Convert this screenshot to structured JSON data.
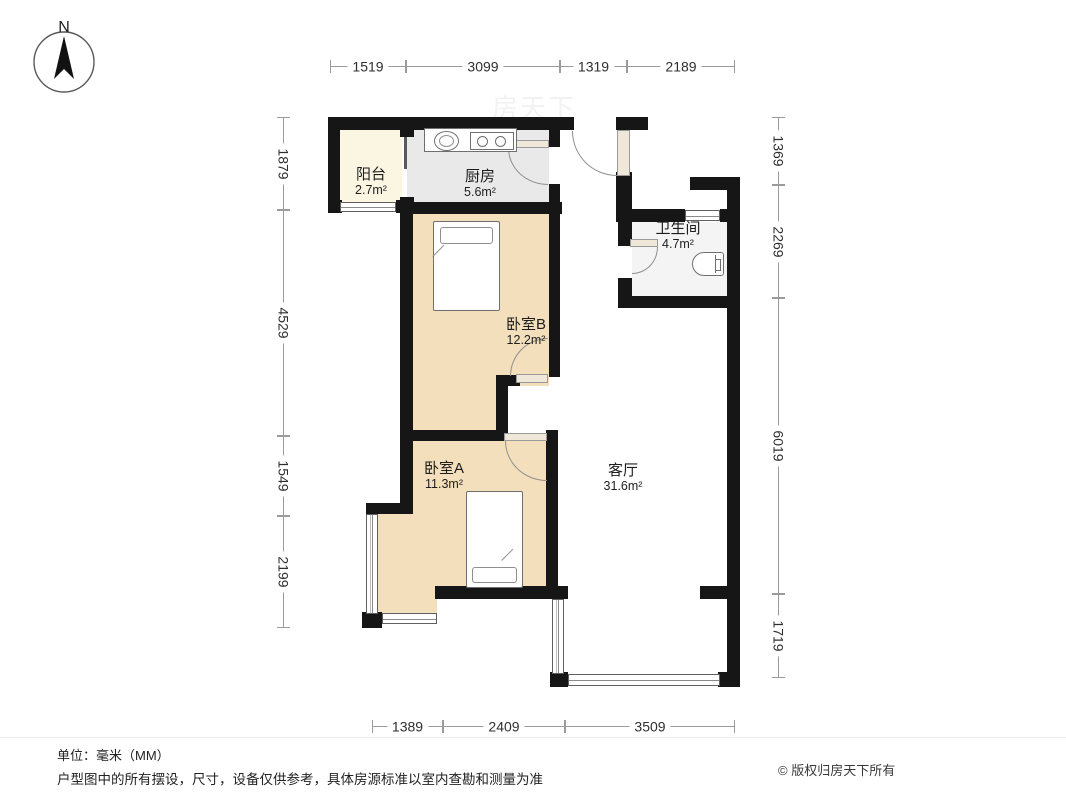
{
  "compass": {
    "label": "N"
  },
  "rooms": {
    "balcony": {
      "name": "阳台",
      "area": "2.7m²"
    },
    "kitchen": {
      "name": "厨房",
      "area": "5.6m²"
    },
    "bathroom": {
      "name": "卫生间",
      "area": "4.7m²"
    },
    "bedroomB": {
      "name": "卧室B",
      "area": "12.2m²"
    },
    "bedroomA": {
      "name": "卧室A",
      "area": "11.3m²"
    },
    "living": {
      "name": "客厅",
      "area": "31.6m²"
    }
  },
  "dimensions": {
    "unit": "mm",
    "top": [
      "1519",
      "3099",
      "1319",
      "2189"
    ],
    "left": [
      "1879",
      "4529",
      "1549",
      "2199"
    ],
    "right": [
      "1369",
      "2269",
      "6019",
      "1719"
    ],
    "bottom": [
      "1389",
      "2409",
      "3509"
    ]
  },
  "footer": {
    "unit_note": "单位：毫米（MM）",
    "disclaimer": "户型图中的所有摆设，尺寸，设备仅供参考，具体房源标准以室内查勘和测量为准",
    "copyright": "© 版权归房天下所有"
  },
  "watermark_text": "房天下",
  "colors": {
    "wall": "#161616",
    "bedroom_floor": "#f3dfbc",
    "balcony_floor": "#fbf6e2",
    "kitchen_floor": "#e9e9e9",
    "bathroom_floor": "#f4f4f4",
    "dimension_line": "#9b9b9b"
  }
}
